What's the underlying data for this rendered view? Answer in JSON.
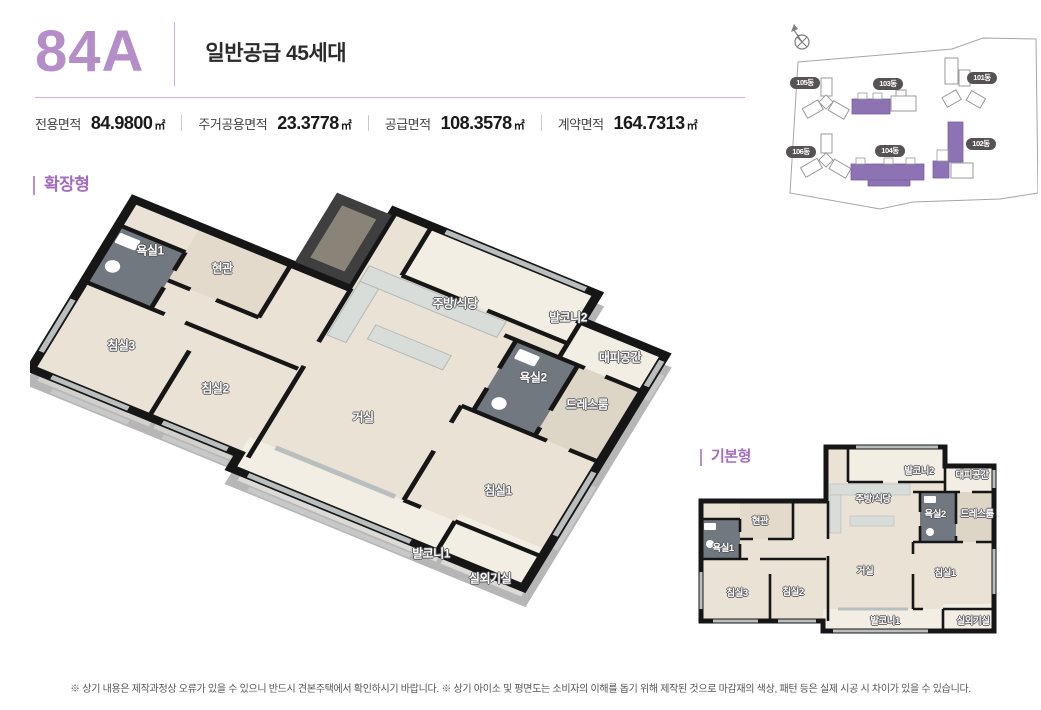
{
  "header": {
    "unit_code": "84A",
    "supply_type": "일반공급 45세대",
    "areas": [
      {
        "label": "전용면적",
        "value": "84.9800",
        "unit": "㎡"
      },
      {
        "label": "주거공용면적",
        "value": "23.3778",
        "unit": "㎡"
      },
      {
        "label": "공급면적",
        "value": "108.3578",
        "unit": "㎡"
      },
      {
        "label": "계약면적",
        "value": "164.7313",
        "unit": "㎡"
      }
    ]
  },
  "sections": {
    "extended_label": "확장형",
    "basic_label": "기본형"
  },
  "floorplan": {
    "rooms": [
      "욕실1",
      "현관",
      "침실3",
      "침실2",
      "거실",
      "주방/식당",
      "발코니2",
      "대피공간",
      "욕실2",
      "드레스룸",
      "침실1",
      "발코니1",
      "실외기실"
    ]
  },
  "site_map": {
    "buildings": [
      {
        "label": "105동",
        "highlighted": false
      },
      {
        "label": "103동",
        "highlighted": true
      },
      {
        "label": "101동",
        "highlighted": false
      },
      {
        "label": "106동",
        "highlighted": false
      },
      {
        "label": "104동",
        "highlighted": true
      },
      {
        "label": "102동",
        "highlighted": true
      }
    ]
  },
  "colors": {
    "accent": "#b58ec9",
    "section_accent": "#a46cc0",
    "badge_bg": "#575254",
    "building_highlight": "#8d73b3",
    "wall": "#161616",
    "floor": "#eae2d5"
  },
  "footer": {
    "disclaimer": "※ 상기 내용은 제작과정상 오류가 있을 수 있으니 반드시 견본주택에서 확인하시기 바랍니다. ※ 상기 아이소 및 평면도는 소비자의 이해를 돕기 위해 제작된 것으로 마감재의 색상, 패턴 등은 실제 시공 시 차이가 있을 수 있습니다."
  }
}
